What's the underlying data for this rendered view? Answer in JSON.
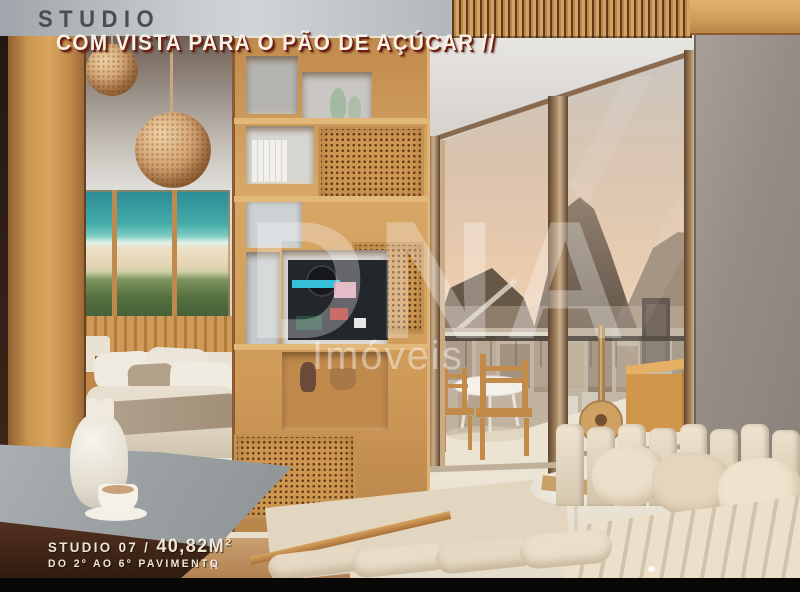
{
  "overlay": {
    "kicker": "STUDIO",
    "headline": "COM VISTA PARA O PÃO DE AÇÚCAR //",
    "unit_label": "STUDIO 07",
    "separator": " / ",
    "area": "40,82M²",
    "floors": "DO 2º AO 6º PAVIMENTO"
  },
  "watermark": {
    "brand": "DNA",
    "word": "Imóveis",
    "mini": "N"
  },
  "colors": {
    "kicker_text": "#4a4e53",
    "headline_text": "#f7f1e6",
    "headline_shadow": "#701e12",
    "footer_text": "#efe6d4",
    "bottom_bar": "#0a0806",
    "wood_light": "#d9a660",
    "wood_dark": "#7a4a24",
    "sky_peach": "#eacbad",
    "wall_gray": "#968e86",
    "sofa_cream": "#e8dcc8",
    "art_turquoise": "#2b8a96"
  }
}
